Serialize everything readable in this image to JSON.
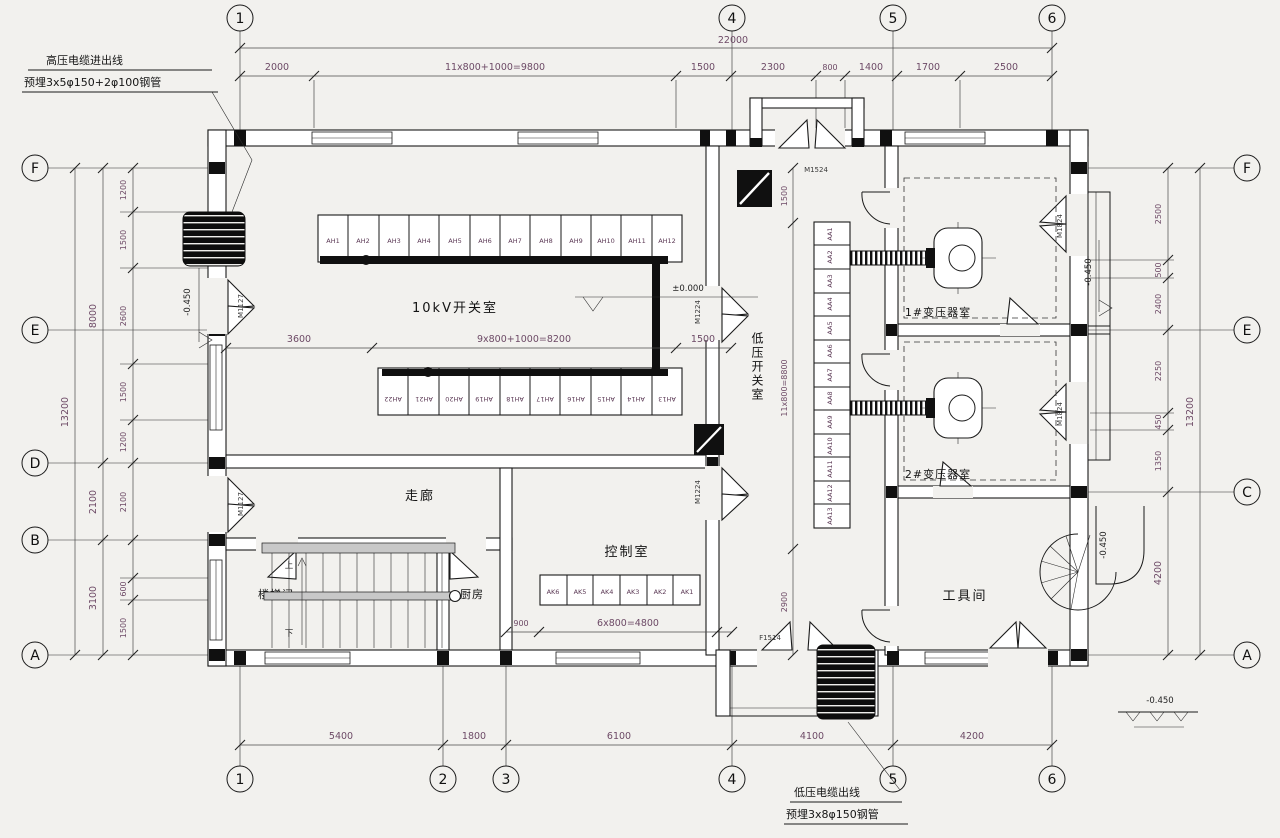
{
  "grid": {
    "top": [
      "1",
      "4",
      "5",
      "6"
    ],
    "bottom": [
      "1",
      "2",
      "3",
      "4",
      "5",
      "6"
    ],
    "left": [
      "F",
      "E",
      "D",
      "B",
      "A"
    ],
    "right": [
      "F",
      "E",
      "C",
      "A"
    ]
  },
  "dims": {
    "top_total": "22000",
    "top": [
      "2000",
      "11x800+1000=9800",
      "1500",
      "2300",
      "800",
      "1400",
      "1700",
      "2500"
    ],
    "bottom": [
      "5400",
      "1800",
      "6100",
      "4100",
      "4200"
    ],
    "left_outer": "13200",
    "left_middle": [
      "8000",
      "2100",
      "3100"
    ],
    "left_inner": [
      "1200",
      "1500",
      "2600",
      "1500",
      "1200",
      "2100",
      "600",
      "1500"
    ],
    "right_outer": "13200",
    "right_inner": [
      "2500",
      "500",
      "2400",
      "2250",
      "450",
      "1350",
      "4200"
    ],
    "room_10kv": [
      "3600",
      "9x800+1000=8200",
      "1500"
    ],
    "control": [
      "900",
      "6x800=4800"
    ],
    "lv_corridor": [
      "1500",
      "11x800=8800",
      "2900"
    ]
  },
  "rooms": {
    "switch10kv": "10kV开关室",
    "lv_switch": "低压开关室",
    "corridor": "走廊",
    "stair": "楼梯间",
    "kitchen": "厨房",
    "control": "控制室",
    "transformer1": "1#变压器室",
    "transformer2": "2#变压器室",
    "tool": "工具间"
  },
  "cabinets": {
    "top": [
      "AH1",
      "AH2",
      "AH3",
      "AH4",
      "AH5",
      "AH6",
      "AH7",
      "AH8",
      "AH9",
      "AH10",
      "AH11",
      "AH12"
    ],
    "bottom": [
      "AH22",
      "AH21",
      "AH20",
      "AH19",
      "AH18",
      "AH17",
      "AH16",
      "AH15",
      "AH14",
      "AH13"
    ],
    "control": [
      "AK6",
      "AK5",
      "AK4",
      "AK3",
      "AK2",
      "AK1"
    ],
    "lv": [
      "AA1",
      "AA2",
      "AA3",
      "AA4",
      "AA5",
      "AA6",
      "AA7",
      "AA8",
      "AA9",
      "AA10",
      "AA11",
      "AA12",
      "AA13"
    ]
  },
  "stairs": {
    "up": "上",
    "down": "下"
  },
  "annotations": {
    "hv_line1": "高压电缆进出线",
    "hv_line2": "预埋3x5φ150+2φ100钢管",
    "lv_line1": "低压电缆出线",
    "lv_line2": "预埋3x8φ150钢管"
  },
  "elevations": {
    "zero": "±0.000",
    "left": "-0.450",
    "right": "-0.450",
    "spiral": "-0.450",
    "ground": "-0.450"
  },
  "door_codes": {
    "top": "M1524",
    "bottom": "F1514",
    "left1": "M1127",
    "left2": "M1127",
    "mid1": "M1224",
    "mid2": "M1224",
    "right1": "M1824",
    "right2": "M1824"
  }
}
